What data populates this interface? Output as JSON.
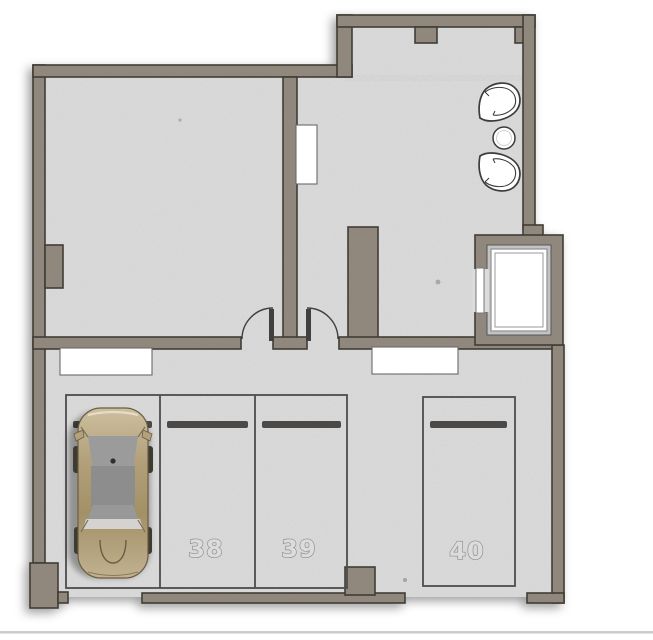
{
  "plan": {
    "kind": "garage-level-floor-plan",
    "stalls": [
      {
        "id": "car-stall",
        "number": "",
        "occupied": true
      },
      {
        "id": "stall-38",
        "number": "38",
        "occupied": false
      },
      {
        "id": "stall-39",
        "number": "39",
        "occupied": false
      },
      {
        "id": "stall-40",
        "number": "40",
        "occupied": false
      }
    ],
    "colors": {
      "background": "#ffffff",
      "wall_fill": "#90887b",
      "wall_outline": "#3f3c36",
      "floor": "#dbdbdb",
      "stall_line": "#4d4d4d",
      "stall_number_outline": "#8d8d8d",
      "car_body": "#b3a17c",
      "car_glass": "#919191",
      "bottom_rule": "#c8ccce"
    },
    "icons": [
      "car-icon",
      "armchair-icon",
      "side-table-icon",
      "elevator-icon",
      "door-swing-icon"
    ]
  }
}
